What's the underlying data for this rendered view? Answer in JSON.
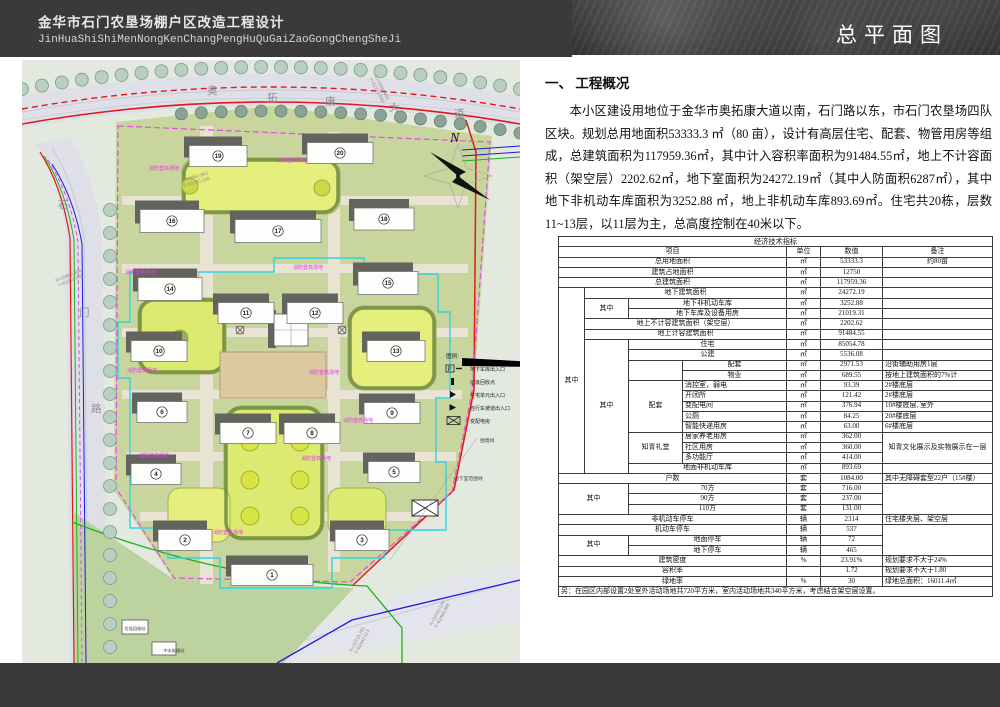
{
  "header": {
    "title_cn": "金华市石门农垦场棚户区改造工程设计",
    "title_py": "JinHuaShiShiMenNongKenChangPengHuQuGaiZaoGongChengSheJi",
    "sheet_title": "总平面图"
  },
  "overview": {
    "heading": "一、 工程概况",
    "body": "本小区建设用地位于金华市奥拓康大道以南，石门路以东，市石门农垦场四队区块。规划总用地面积53333.3 ㎡（80 亩），设计有高层住宅、配套、物管用房等组成，总建筑面积为117959.36㎡，其中计入容积率面积为91484.55㎡，地上不计容面积（架空层）2202.62㎡，地下室面积为24272.19㎡（其中人防面积6287㎡），其中地下非机动车库面积为3252.88 ㎡，地上非机动车库893.69㎡。住宅共20栋，层数11~13层，以11层为主，总高度控制在40米以下。"
  },
  "table": {
    "rows": [
      {
        "cells": [
          {
            "t": "经济技术指标",
            "cs": 7,
            "cls": "c"
          }
        ]
      },
      {
        "cells": [
          {
            "t": "项目",
            "cs": 4
          },
          {
            "t": "单位"
          },
          {
            "t": "数值"
          },
          {
            "t": "备注"
          }
        ]
      },
      {
        "cells": [
          {
            "t": "总用地面积",
            "cs": 4
          },
          {
            "t": "㎡"
          },
          {
            "t": "53333.3"
          },
          {
            "t": "约80亩"
          }
        ]
      },
      {
        "cells": [
          {
            "t": "建筑占地面积",
            "cs": 4
          },
          {
            "t": "㎡"
          },
          {
            "t": "12750"
          },
          {
            "t": ""
          }
        ]
      },
      {
        "cells": [
          {
            "t": "总建筑面积",
            "cs": 4
          },
          {
            "t": "㎡"
          },
          {
            "t": "117959.36"
          },
          {
            "t": ""
          }
        ]
      },
      {
        "cells": [
          {
            "t": "其中",
            "rs": 18
          },
          {
            "t": "地下建筑面积",
            "cs": 3
          },
          {
            "t": "㎡"
          },
          {
            "t": "24272.19"
          },
          {
            "t": ""
          }
        ]
      },
      {
        "cells": [
          {
            "t": "其中",
            "rs": 2
          },
          {
            "t": "地下非机动车库",
            "cs": 2
          },
          {
            "t": "㎡"
          },
          {
            "t": "3252.88"
          },
          {
            "t": ""
          }
        ]
      },
      {
        "cells": [
          {
            "t": "地下车库及设备用房",
            "cs": 2
          },
          {
            "t": "㎡"
          },
          {
            "t": "21019.31"
          },
          {
            "t": ""
          }
        ]
      },
      {
        "cells": [
          {
            "t": "地上不计容建筑面积（架空层）",
            "cs": 3
          },
          {
            "t": "㎡"
          },
          {
            "t": "2202.62"
          },
          {
            "t": ""
          }
        ]
      },
      {
        "cells": [
          {
            "t": "地上计容建筑面积",
            "cs": 3
          },
          {
            "t": "㎡"
          },
          {
            "t": "91484.55"
          },
          {
            "t": ""
          }
        ]
      },
      {
        "cells": [
          {
            "t": "其中",
            "rs": 13
          },
          {
            "t": "住宅",
            "cs": 2
          },
          {
            "t": "㎡"
          },
          {
            "t": "85054.78"
          },
          {
            "t": ""
          }
        ]
      },
      {
        "cells": [
          {
            "t": "公建",
            "cs": 2
          },
          {
            "t": "㎡"
          },
          {
            "t": "5536.08"
          },
          {
            "t": ""
          }
        ]
      },
      {
        "cells": [
          {
            "t": "",
            "rs": 2
          },
          {
            "t": "配套"
          },
          {
            "t": "㎡"
          },
          {
            "t": "2971.53"
          },
          {
            "t": "沿街辅助用房1层",
            "cls": "l"
          }
        ]
      },
      {
        "cells": [
          {
            "t": "物业"
          },
          {
            "t": "㎡"
          },
          {
            "t": "689.55"
          },
          {
            "t": "按地上建筑面积的7%计",
            "cls": "l"
          }
        ]
      },
      {
        "cells": [
          {
            "t": "配套",
            "rs": 5
          },
          {
            "t": "消控室，弱电",
            "cls": "l"
          },
          {
            "t": "㎡"
          },
          {
            "t": "93.39"
          },
          {
            "t": "2#楼底层",
            "cls": "l"
          }
        ]
      },
      {
        "cells": [
          {
            "t": "开闭所",
            "cls": "l"
          },
          {
            "t": "㎡"
          },
          {
            "t": "121.42"
          },
          {
            "t": "2#楼底层",
            "cls": "l"
          }
        ]
      },
      {
        "cells": [
          {
            "t": "变配电间",
            "cls": "l"
          },
          {
            "t": "㎡"
          },
          {
            "t": "376.94"
          },
          {
            "t": "10#楼底层, 室外",
            "cls": "l"
          }
        ]
      },
      {
        "cells": [
          {
            "t": "公厕",
            "cls": "l"
          },
          {
            "t": "㎡"
          },
          {
            "t": "84.25"
          },
          {
            "t": "20#楼底层",
            "cls": "l"
          }
        ]
      },
      {
        "cells": [
          {
            "t": "智能快递用房",
            "cls": "l"
          },
          {
            "t": "㎡"
          },
          {
            "t": "63.00"
          },
          {
            "t": "6#楼底层",
            "cls": "l"
          }
        ]
      },
      {
        "cells": [
          {
            "t": "知青礼堂",
            "rs": 3
          },
          {
            "t": "居家养老用房",
            "cls": "l"
          },
          {
            "t": "㎡"
          },
          {
            "t": "362.00"
          },
          {
            "t": "知青文化展示及实物展示在一层",
            "rs": 3
          }
        ]
      },
      {
        "cells": [
          {
            "t": "社区用房",
            "cls": "l"
          },
          {
            "t": "㎡"
          },
          {
            "t": "360.00"
          }
        ]
      },
      {
        "cells": [
          {
            "t": "多功能厅",
            "cls": "l"
          },
          {
            "t": "㎡"
          },
          {
            "t": "414.00"
          }
        ]
      },
      {
        "cells": [
          {
            "t": "地面非机动车库",
            "cs": 2
          },
          {
            "t": "㎡"
          },
          {
            "t": "893.69"
          },
          {
            "t": ""
          }
        ]
      },
      {
        "cells": [
          {
            "t": "户数",
            "cs": 4
          },
          {
            "t": "套"
          },
          {
            "t": "1084.00"
          },
          {
            "t": "其中无障碍套型22户（15#楼）",
            "cls": "l"
          }
        ]
      },
      {
        "cells": [
          {
            "t": "其中",
            "cs": 2,
            "rs": 3
          },
          {
            "t": "70方",
            "cs": 2
          },
          {
            "t": "套"
          },
          {
            "t": "716.00"
          },
          {
            "t": "",
            "rs": 3
          }
        ]
      },
      {
        "cells": [
          {
            "t": "90方",
            "cs": 2
          },
          {
            "t": "套"
          },
          {
            "t": "237.00"
          }
        ]
      },
      {
        "cells": [
          {
            "t": "110方",
            "cs": 2
          },
          {
            "t": "套"
          },
          {
            "t": "131.00"
          }
        ]
      },
      {
        "cells": [
          {
            "t": "非机动车停车",
            "cs": 4
          },
          {
            "t": "辆"
          },
          {
            "t": "2314"
          },
          {
            "t": "住宅楼夹层、架空层",
            "cls": "l"
          }
        ]
      },
      {
        "cells": [
          {
            "t": "机动车停车",
            "cs": 4
          },
          {
            "t": "辆"
          },
          {
            "t": "537"
          },
          {
            "t": "",
            "rs": 3
          }
        ]
      },
      {
        "cells": [
          {
            "t": "其中",
            "cs": 2,
            "rs": 2
          },
          {
            "t": "地面停车",
            "cs": 2
          },
          {
            "t": "辆"
          },
          {
            "t": "72"
          }
        ]
      },
      {
        "cells": [
          {
            "t": "地下停车",
            "cs": 2
          },
          {
            "t": "辆"
          },
          {
            "t": "465"
          }
        ]
      },
      {
        "cells": [
          {
            "t": "建筑密度",
            "cs": 4
          },
          {
            "t": "%"
          },
          {
            "t": "23.91%"
          },
          {
            "t": "规划要求不大于24%",
            "cls": "l"
          }
        ]
      },
      {
        "cells": [
          {
            "t": "容积率",
            "cs": 4
          },
          {
            "t": ""
          },
          {
            "t": "1.72"
          },
          {
            "t": "规划要求不大于1.80",
            "cls": "l"
          }
        ]
      },
      {
        "cells": [
          {
            "t": "绿地率",
            "cs": 4
          },
          {
            "t": "%"
          },
          {
            "t": "30"
          },
          {
            "t": "绿地总面积：16011.4㎡",
            "cls": "l"
          }
        ]
      },
      {
        "cells": [
          {
            "t": "另：在园区内部设置2处室外活动场地共720平方米，室内活动场地共340平方米，考虑结合架空层设置。",
            "cs": 7,
            "cls": "l"
          }
        ]
      }
    ]
  },
  "map": {
    "north_label": "N",
    "road_top": {
      "name": "奥拓康大道",
      "chars": [
        {
          "c": "奥",
          "x": 185,
          "y": 34
        },
        {
          "c": "拓",
          "x": 245,
          "y": 41
        },
        {
          "c": "康",
          "x": 303,
          "y": 45
        },
        {
          "c": "大",
          "x": 367,
          "y": 51
        },
        {
          "c": "道",
          "x": 432,
          "y": 57
        }
      ]
    },
    "road_left": {
      "name": "石门路",
      "chars": [
        {
          "c": "石",
          "x": 36,
          "y": 148
        },
        {
          "c": "门",
          "x": 57,
          "y": 256
        },
        {
          "c": "路",
          "x": 69,
          "y": 352
        }
      ]
    },
    "legend": {
      "title": "图例:",
      "items": [
        {
          "sym": "p-arrow",
          "label": "地下车库出入口"
        },
        {
          "sym": "bar",
          "label": "垃圾回收点"
        },
        {
          "sym": "tri",
          "label": "住宅单元出入口"
        },
        {
          "sym": "tri-s",
          "label": "自行车坡道出入口"
        },
        {
          "sym": "xbox",
          "label": "变配电房"
        }
      ]
    },
    "buildings": [
      {
        "n": "19",
        "x": 196,
        "y": 96,
        "w": 58,
        "h": 21
      },
      {
        "n": "20",
        "x": 318,
        "y": 93,
        "w": 66,
        "h": 21
      },
      {
        "n": "16",
        "x": 150,
        "y": 161,
        "w": 64,
        "h": 23
      },
      {
        "n": "17",
        "x": 256,
        "y": 171,
        "w": 86,
        "h": 23
      },
      {
        "n": "18",
        "x": 362,
        "y": 159,
        "w": 60,
        "h": 22
      },
      {
        "n": "14",
        "x": 148,
        "y": 229,
        "w": 64,
        "h": 23
      },
      {
        "n": "15",
        "x": 366,
        "y": 223,
        "w": 60,
        "h": 23
      },
      {
        "n": "11",
        "x": 224,
        "y": 253,
        "w": 56,
        "h": 21
      },
      {
        "n": "12",
        "x": 293,
        "y": 253,
        "w": 56,
        "h": 21
      },
      {
        "n": "10",
        "x": 137,
        "y": 291,
        "w": 56,
        "h": 21
      },
      {
        "n": "13",
        "x": 374,
        "y": 291,
        "w": 58,
        "h": 21
      },
      {
        "n": "6",
        "x": 140,
        "y": 352,
        "w": 50,
        "h": 21
      },
      {
        "n": "9",
        "x": 370,
        "y": 353,
        "w": 56,
        "h": 21
      },
      {
        "n": "7",
        "x": 226,
        "y": 373,
        "w": 56,
        "h": 21
      },
      {
        "n": "8",
        "x": 290,
        "y": 373,
        "w": 56,
        "h": 21
      },
      {
        "n": "4",
        "x": 134,
        "y": 414,
        "w": 50,
        "h": 21
      },
      {
        "n": "5",
        "x": 372,
        "y": 412,
        "w": 52,
        "h": 21
      },
      {
        "n": "2",
        "x": 163,
        "y": 480,
        "w": 54,
        "h": 21
      },
      {
        "n": "3",
        "x": 340,
        "y": 480,
        "w": 54,
        "h": 21
      },
      {
        "n": "1",
        "x": 250,
        "y": 515,
        "w": 82,
        "h": 21
      }
    ],
    "coords": [
      {
        "l1": "X=10994.443",
        "l2": "Y=62271.598",
        "x": 352,
        "y": 16,
        "rot": 62
      },
      {
        "l1": "X=10962.842",
        "l2": "Y=62265.190",
        "x": 160,
        "y": 122,
        "rot": -16
      },
      {
        "l1": "X=10809.306",
        "l2": "Y=62311.364",
        "x": 34,
        "y": 222,
        "rot": -22
      },
      {
        "l1": "X=10743.134",
        "l2": "Y=62469.368",
        "x": 410,
        "y": 566,
        "rot": -62
      },
      {
        "l1": "X=10718.292",
        "l2": "Y=62442.013",
        "x": 330,
        "y": 592,
        "rot": -62
      }
    ],
    "fire_text": "消防登高场地",
    "fire_labels": [
      {
        "x": 142,
        "y": 110
      },
      {
        "x": 270,
        "y": 102
      },
      {
        "x": 118,
        "y": 214
      },
      {
        "x": 286,
        "y": 209
      },
      {
        "x": 120,
        "y": 312
      },
      {
        "x": 302,
        "y": 314
      },
      {
        "x": 132,
        "y": 397
      },
      {
        "x": 294,
        "y": 400
      },
      {
        "x": 206,
        "y": 474
      },
      {
        "x": 336,
        "y": 362
      }
    ],
    "annotations": [
      {
        "t": "围墙线",
        "x": 458,
        "y": 382
      },
      {
        "t": "地下室范围线",
        "x": 432,
        "y": 420
      }
    ],
    "utilities": [
      {
        "t": "垃圾回收站",
        "x": 113,
        "y": 570
      },
      {
        "t": "中水处理站",
        "x": 152,
        "y": 592
      }
    ],
    "colors": {
      "red_line": "#e01818",
      "magenta_line": "#e34ae3",
      "cyan_line": "#2fd4e0",
      "blue_line": "#1a1ae0",
      "green_line": "#19b419",
      "road_fill": "#dfdfe8",
      "parcel_fill": "#c8d69e",
      "lawn_fill": "#e6ef7d",
      "plaza_fill": "#dcc9a0"
    }
  }
}
